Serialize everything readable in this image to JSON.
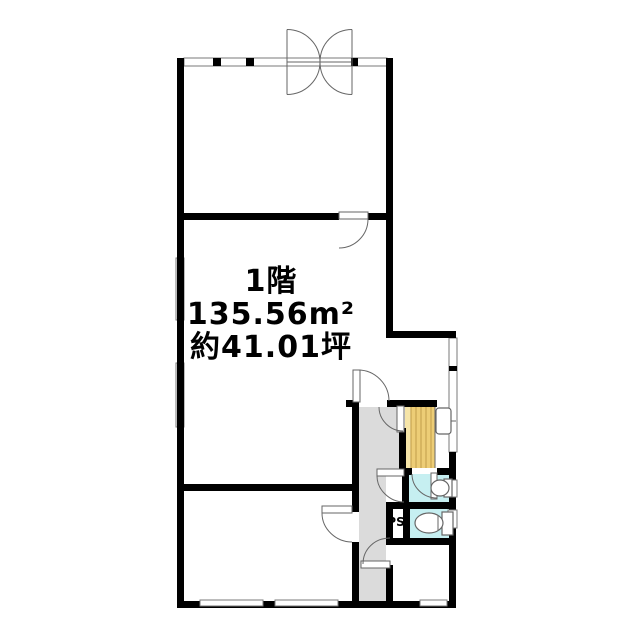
{
  "plan": {
    "labels": {
      "floor": "1階",
      "area": "135.56m²",
      "tsubo": "約41.01坪",
      "pipe_space": "PS"
    },
    "colors": {
      "wall": "#000000",
      "background": "#ffffff",
      "corridor": "#dbdbdb",
      "stairs": "#edcd76",
      "stairs_highlight": "#f6e5a8",
      "stairs_stripe": "#c9a551",
      "toilet": "#c6eff1",
      "line": "#555555"
    }
  }
}
